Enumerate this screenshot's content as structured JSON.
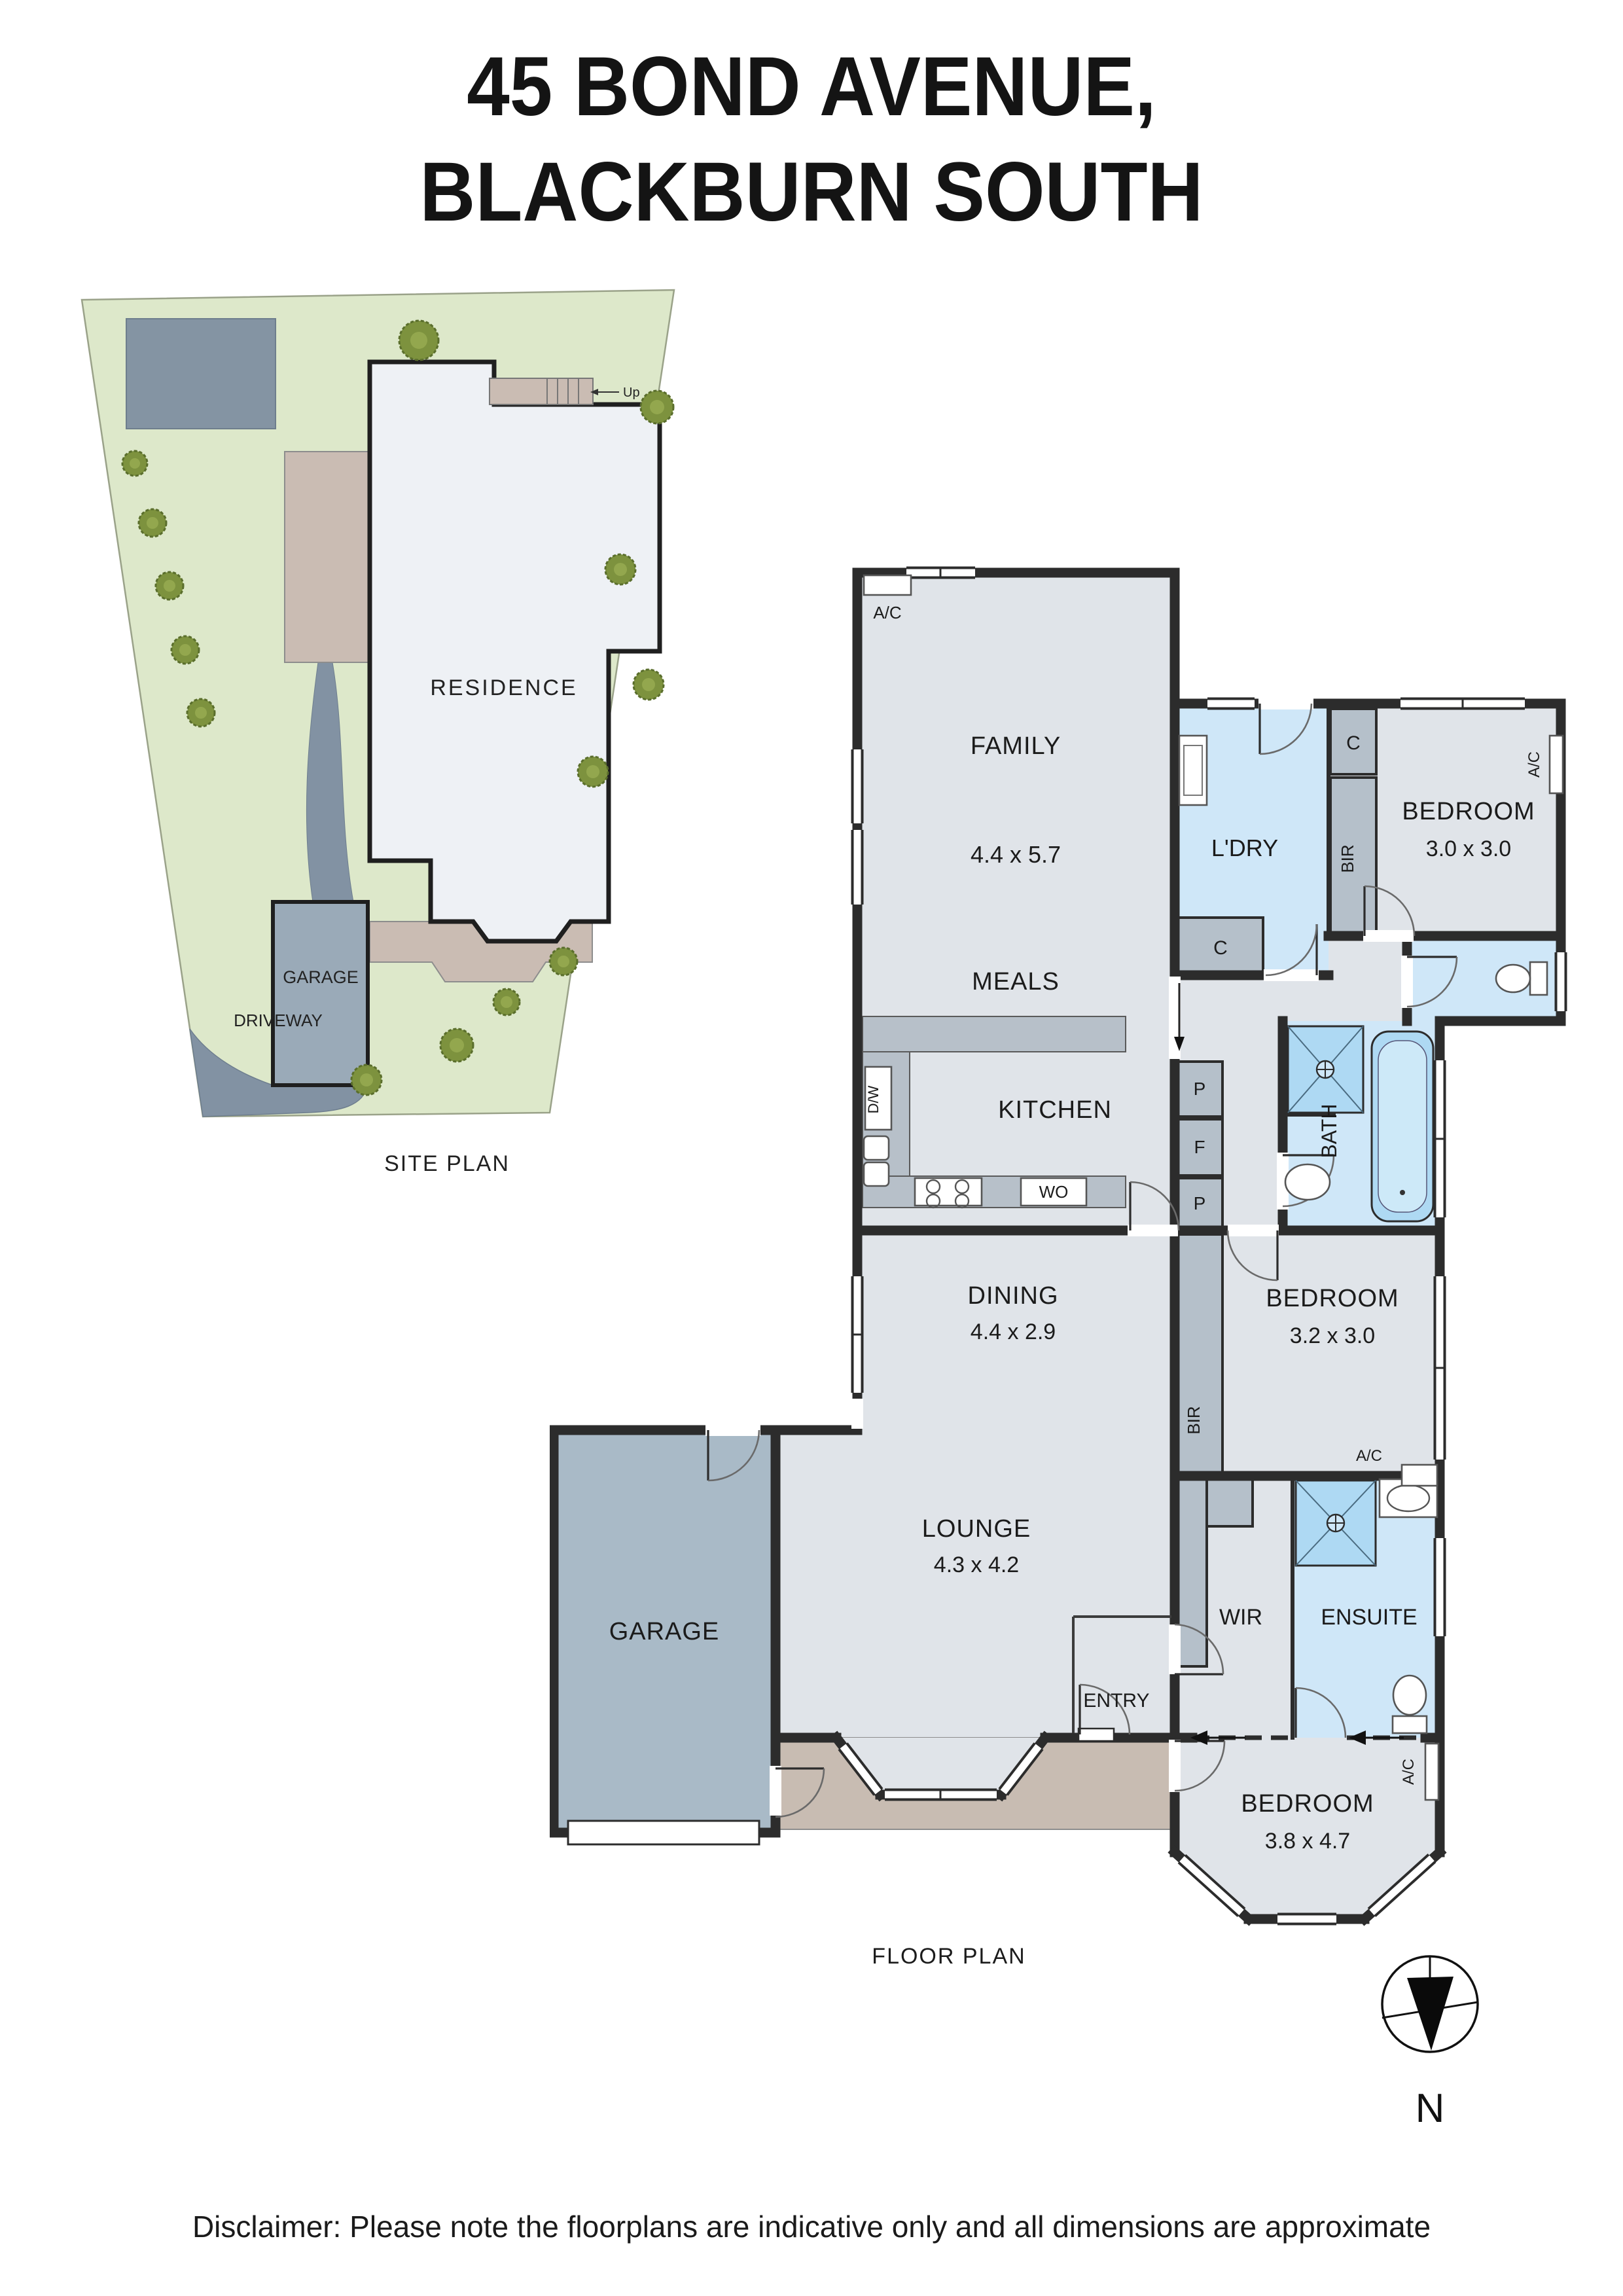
{
  "title": {
    "line1": "45 BOND AVENUE,",
    "line2": "BLACKBURN SOUTH"
  },
  "site_plan": {
    "caption": "SITE PLAN",
    "residence_label": "RESIDENCE",
    "garage_label": "GARAGE",
    "driveway_label": "DRIVEWAY",
    "stairs_label": "Up"
  },
  "floor_plan": {
    "caption": "FLOOR PLAN",
    "rooms": {
      "family": {
        "name": "FAMILY",
        "dims": "4.4 x 5.7"
      },
      "meals": {
        "name": "MEALS"
      },
      "kitchen": {
        "name": "KITCHEN"
      },
      "dining": {
        "name": "DINING",
        "dims": "4.4 x 2.9"
      },
      "lounge": {
        "name": "LOUNGE",
        "dims": "4.3 x 4.2"
      },
      "garage": {
        "name": "GARAGE"
      },
      "entry": {
        "name": "ENTRY"
      },
      "laundry": {
        "name": "L'DRY"
      },
      "bath": {
        "name": "BATH"
      },
      "wir": {
        "name": "WIR"
      },
      "ensuite": {
        "name": "ENSUITE"
      },
      "bedroom1": {
        "name": "BEDROOM",
        "dims": "3.0 x 3.0"
      },
      "bedroom2": {
        "name": "BEDROOM",
        "dims": "3.2 x 3.0"
      },
      "bedroom3": {
        "name": "BEDROOM",
        "dims": "3.8 x 4.7"
      }
    },
    "labels": {
      "ac": "A/C",
      "bir": "BIR",
      "cupboard": "C",
      "pantry": "P",
      "fridge": "F",
      "wall_oven": "WO",
      "dishwasher": "D/W"
    }
  },
  "compass": {
    "north_label": "N"
  },
  "disclaimer": "Disclaimer: Please note the floorplans are indicative only and all dimensions are approximate",
  "colors": {
    "wall": "#2c2c2c",
    "floor": "#e0e4e9",
    "wet_area": "#cfe7f8",
    "fixture_blue": "#aed9f3",
    "joinery_gray": "#b5c0ca",
    "garage_floor": "#a9bac7",
    "porch": "#c8bcb2",
    "site_grass": "#dde8ca",
    "site_paving": "#8292a3",
    "site_patio": "#cabcb3",
    "tree": "#7d923e"
  }
}
